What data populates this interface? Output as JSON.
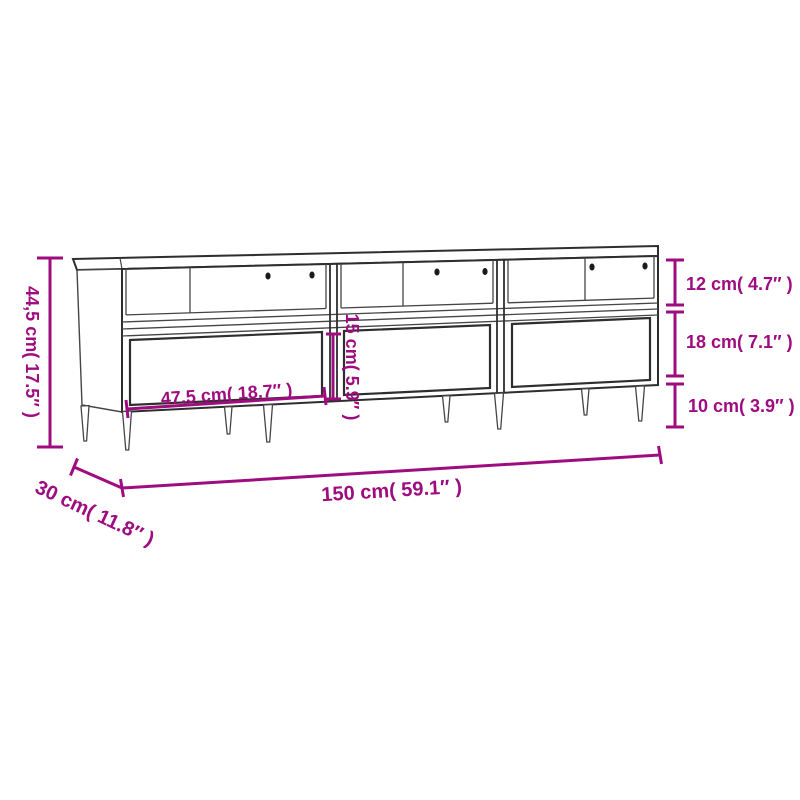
{
  "canvas": {
    "width": 800,
    "height": 800,
    "background": "#ffffff"
  },
  "colors": {
    "dimension_accent": "#9F0C7F",
    "outline_dark": "#2e2e2e",
    "outline_gray": "#454545",
    "hole_fill": "#1a1a1a"
  },
  "drawing": {
    "subject": "tv-stand-line-drawing",
    "sections": "3",
    "drawers": "3",
    "legs": "8",
    "cable_holes_per_section": "2"
  },
  "dimensions": {
    "total_height": {
      "label": "44,5 cm( 17.5″ )",
      "cm": "44,5",
      "inch": "17.5"
    },
    "total_width": {
      "label": "150 cm( 59.1″ )",
      "cm": "150",
      "inch": "59.1"
    },
    "total_depth": {
      "label": "30 cm( 11.8″ )",
      "cm": "30",
      "inch": "11.8"
    },
    "compartment_width": {
      "label": "47,5 cm( 18.7″ )",
      "cm": "47,5",
      "inch": "18.7"
    },
    "drawer_front_height": {
      "label": "15 cm( 5.9″ )",
      "cm": "15",
      "inch": "5.9"
    },
    "top_shelf_height": {
      "label": "12 cm( 4.7″ )",
      "cm": "12",
      "inch": "4.7"
    },
    "drawer_section_height": {
      "label": "18 cm( 7.1″ )",
      "cm": "18",
      "inch": "7.1"
    },
    "leg_height": {
      "label": "10 cm( 3.9″ )",
      "cm": "10",
      "inch": "3.9"
    }
  }
}
